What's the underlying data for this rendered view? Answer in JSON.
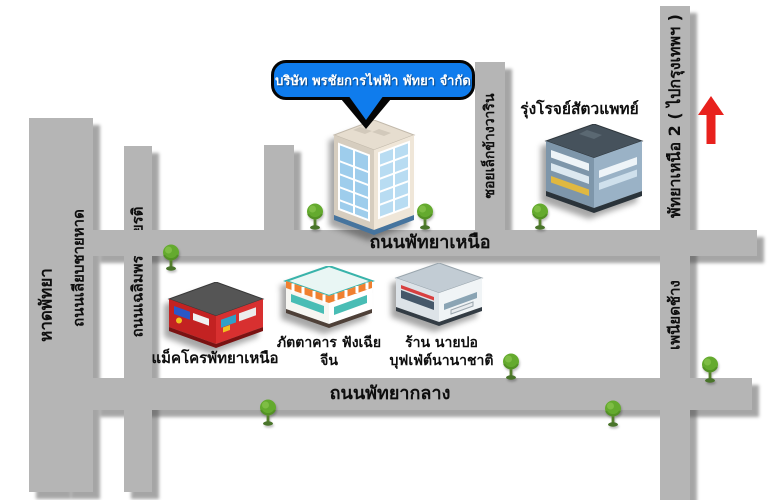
{
  "map": {
    "callout_label": "บริษัท พรชัยการไฟฟ้า พัทยา จำกัด",
    "roads": {
      "beach": "หาดพัทยา",
      "beach_road": "ถนนเลียบชายหาด",
      "chaloem_phrakiat_road": "ถนนเฉลิมพระเกียรติ",
      "north_pattaya_road": "ถนนพัทยาเหนือ",
      "central_pattaya_road": "ถนนพัทยากลาง",
      "soi_lek_khang_warin": "ซอยเล็กข้างวาริน",
      "north_pattaya_2_bangkok": "พัทยาเหนือ 2 ( ไปกรุงเทพฯ )",
      "phaniat_chang": "เพนียดช้าง"
    },
    "places": {
      "vet_clinic": "รุ่งโรจย์สัตวแพทย์",
      "makro": "แม็คโครพัทยาเหนือ",
      "chinese_restaurant_line1": "ภัตตาคาร ฟังเฉีย",
      "chinese_restaurant_line2": "จีน",
      "buffet_shop_line1": "ร้าน นายปอ",
      "buffet_shop_line2": "บุฟเฟ่ต์นานาชาติ"
    },
    "colors": {
      "callout_blue": "#0f7ced",
      "road_gray": "#b5b5b5",
      "beach_yellow": "#ffc41a",
      "arrow_red": "#e8211d",
      "tree_green": "#64aa2e",
      "shadow_gray": "#4e4e4e"
    }
  }
}
